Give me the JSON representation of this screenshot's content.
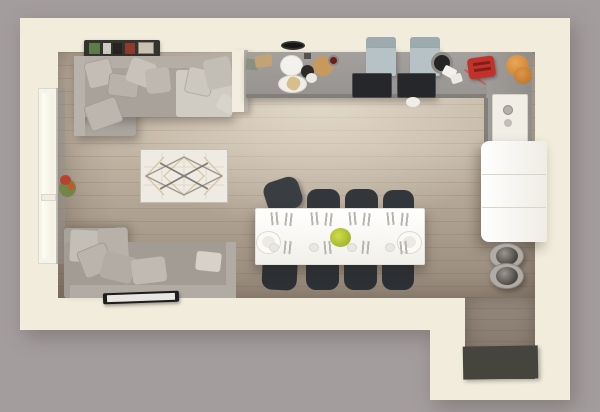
{
  "scene": {
    "label": "3D top-down floor plan render of an open-plan living room, dining area, kitchen and entryway with dark door mat"
  },
  "palette": {
    "background": "#a49d9d",
    "wall": "#f1ecdc",
    "floor_light": "#c4b7a6",
    "floor_dark": "#a2968a",
    "counter_gray": "#9d9996",
    "sofa_gray": "#a8a29b",
    "pillow_gray": "#c3bdb5",
    "chair_dark": "#33373c",
    "chair_blue": "#b6c2c5",
    "table_white": "#ffffff",
    "fridge_white": "#f9f7f2",
    "mat_dark": "#45453e",
    "accent_red": "#c2322a",
    "accent_orange": "#d78e3c",
    "accent_green_centerpiece": "#aabf2e",
    "plant_red": "#b8422c",
    "rug_cream": "#efebe3"
  },
  "furniture": [
    {
      "name": "window-left-frame",
      "x": 38,
      "y": 88,
      "w": 20,
      "h": 176,
      "bg": "#f6f3e9",
      "border": "1px solid #dedacb"
    },
    {
      "name": "window-left-pane",
      "x": 42,
      "y": 93,
      "w": 11,
      "h": 166,
      "bg": "linear-gradient(90deg,#fffef6,#f3f0e2)"
    },
    {
      "name": "window-left-sill",
      "x": 41,
      "y": 194,
      "w": 15,
      "h": 7,
      "bg": "#f0ede0",
      "border": "1px solid #dcd8c9"
    },
    {
      "name": "left-wall-inner-face",
      "x": 56,
      "y": 88,
      "w": 9,
      "h": 176,
      "bg": "#989390",
      "opacity": 0.55
    },
    {
      "name": "plant-leaves",
      "shape": "ellipse",
      "x": 59,
      "y": 179,
      "w": 17,
      "h": 18,
      "bg": "#72864a"
    },
    {
      "name": "plant-flowers",
      "shape": "ellipse",
      "x": 60,
      "y": 175,
      "w": 11,
      "h": 10,
      "bg": "#b8422c"
    },
    {
      "name": "plant-flower-2",
      "shape": "ellipse",
      "x": 68,
      "y": 183,
      "w": 7,
      "h": 7,
      "bg": "#c2582f"
    },
    {
      "name": "picture-shelf",
      "x": 84,
      "y": 40,
      "w": 76,
      "h": 17,
      "bg": "#35332f",
      "radius": "2px",
      "shadow": "0 2px 4px rgba(0,0,0,.3)"
    },
    {
      "name": "shelf-book-green",
      "x": 89,
      "y": 43,
      "w": 11,
      "h": 11,
      "bg": "#5c7c4a"
    },
    {
      "name": "shelf-book-white",
      "x": 103,
      "y": 43,
      "w": 8,
      "h": 11,
      "bg": "#cfcabf"
    },
    {
      "name": "shelf-book-dark",
      "x": 113,
      "y": 43,
      "w": 9,
      "h": 11,
      "bg": "#26241f"
    },
    {
      "name": "shelf-book-red",
      "x": 125,
      "y": 43,
      "w": 10,
      "h": 11,
      "bg": "#8e3a2e"
    },
    {
      "name": "shelf-art-print",
      "x": 138,
      "y": 42,
      "w": 16,
      "h": 12,
      "bg": "#c9c2b2",
      "border": "1px solid #8b857a"
    },
    {
      "name": "sofa-top-chaise",
      "x": 74,
      "y": 56,
      "w": 62,
      "h": 80,
      "bg": "#aba59e",
      "radius": "3px",
      "shadow": "3px 5px 9px rgba(40,35,30,.32)"
    },
    {
      "name": "sofa-top-base",
      "x": 74,
      "y": 56,
      "w": 158,
      "h": 61,
      "bg": "#a8a29b",
      "radius": "3px",
      "shadow": "3px 5px 9px rgba(40,35,30,.32)"
    },
    {
      "name": "sofa-top-armrest-left",
      "x": 74,
      "y": 56,
      "w": 11,
      "h": 80,
      "bg": "#b8b2ab"
    },
    {
      "name": "sofa-top-seat-right",
      "x": 176,
      "y": 70,
      "w": 56,
      "h": 47,
      "bg": "#d0cbc3",
      "radius": "3px"
    },
    {
      "name": "sofa-top-backrest",
      "x": 85,
      "y": 56,
      "w": 147,
      "h": 12,
      "bg": "#b4aea7"
    },
    {
      "name": "pillow-1",
      "x": 86,
      "y": 60,
      "w": 27,
      "h": 27,
      "bg": "#c3bdb5",
      "rot": -14,
      "radius": "4px",
      "border": "1px solid #a8a29a"
    },
    {
      "name": "pillow-2",
      "x": 108,
      "y": 74,
      "w": 31,
      "h": 23,
      "bg": "#b8b2aa",
      "rot": 7,
      "radius": "4px",
      "border": "1px solid #a29c94"
    },
    {
      "name": "pillow-3",
      "x": 128,
      "y": 60,
      "w": 26,
      "h": 25,
      "bg": "#c8c2ba",
      "rot": 20,
      "radius": "4px"
    },
    {
      "name": "pillow-4",
      "x": 146,
      "y": 68,
      "w": 24,
      "h": 25,
      "bg": "#beb8b0",
      "rot": -6,
      "radius": "4px"
    },
    {
      "name": "pillow-5",
      "x": 186,
      "y": 68,
      "w": 27,
      "h": 27,
      "bg": "#ccc7bf",
      "rot": 12,
      "radius": "4px",
      "border": "1px solid #b2ada5"
    },
    {
      "name": "pillow-6",
      "x": 205,
      "y": 58,
      "w": 27,
      "h": 30,
      "bg": "#c2bdb5",
      "rot": -12,
      "radius": "4px"
    },
    {
      "name": "pillow-7",
      "x": 90,
      "y": 97,
      "w": 27,
      "h": 34,
      "bg": "#bcb6ae",
      "rot": 70,
      "radius": "4px",
      "border": "1px solid #a39d95"
    },
    {
      "name": "pillow-8",
      "x": 218,
      "y": 96,
      "w": 18,
      "h": 16,
      "bg": "#d8d4cc",
      "rot": 30,
      "radius": "3px"
    },
    {
      "name": "sofa-bottom-chaise",
      "x": 64,
      "y": 228,
      "w": 64,
      "h": 70,
      "bg": "#a8a29b",
      "radius": "3px",
      "shadow": "3px -3px 8px rgba(40,35,30,.25)"
    },
    {
      "name": "sofa-bottom-base",
      "x": 64,
      "y": 242,
      "w": 172,
      "h": 56,
      "bg": "#a29c95",
      "radius": "3px"
    },
    {
      "name": "sofa-bottom-backrest",
      "x": 70,
      "y": 285,
      "w": 166,
      "h": 13,
      "bg": "#b1aba4"
    },
    {
      "name": "sofa-bottom-armrest-right",
      "x": 226,
      "y": 242,
      "w": 10,
      "h": 56,
      "bg": "#b1aba4"
    },
    {
      "name": "cushion-block-1",
      "x": 70,
      "y": 230,
      "w": 28,
      "h": 32,
      "bg": "#c3beb6",
      "rot": 3,
      "radius": "3px"
    },
    {
      "name": "cushion-block-2",
      "x": 98,
      "y": 228,
      "w": 30,
      "h": 34,
      "bg": "#b7b1a9",
      "rot": -4,
      "radius": "3px"
    },
    {
      "name": "pillow-9",
      "x": 80,
      "y": 246,
      "w": 31,
      "h": 29,
      "bg": "#bab4ac",
      "rot": -22,
      "radius": "4px",
      "border": "1px solid #a19b93"
    },
    {
      "name": "pillow-10",
      "x": 102,
      "y": 254,
      "w": 32,
      "h": 27,
      "bg": "#b2aca4",
      "rot": 14,
      "radius": "4px"
    },
    {
      "name": "pillow-11",
      "x": 132,
      "y": 258,
      "w": 34,
      "h": 25,
      "bg": "#c0bab2",
      "rot": -7,
      "radius": "4px"
    },
    {
      "name": "pillow-12",
      "x": 196,
      "y": 252,
      "w": 25,
      "h": 19,
      "bg": "#d6d2ca",
      "rot": 6,
      "radius": "3px"
    },
    {
      "name": "tv",
      "x": 103,
      "y": 292,
      "w": 76,
      "h": 11,
      "bg": "#1e1d1b",
      "radius": "2px",
      "rot": -2,
      "shadow": "1px 2px 3px rgba(0,0,0,.35)"
    },
    {
      "name": "tv-screen",
      "x": 107,
      "y": 294,
      "w": 68,
      "h": 7,
      "bg": "#e8e7e3",
      "rot": -2
    },
    {
      "name": "partition-wall",
      "x": 232,
      "y": 50,
      "w": 15,
      "h": 62,
      "bg": "#f2edde",
      "shadow": "4px 3px 6px rgba(0,0,0,.22)"
    },
    {
      "name": "partition-wall-face",
      "x": 244,
      "y": 50,
      "w": 4,
      "h": 62,
      "bg": "#b7b2a9"
    },
    {
      "name": "kitchen-counter",
      "x": 246,
      "y": 52,
      "w": 192,
      "h": 46,
      "bg": "linear-gradient(180deg,#a4a09d,#96928f)",
      "shadow": "0 4px 6px rgba(40,35,30,.3)"
    },
    {
      "name": "corner-counter-top",
      "x": 438,
      "y": 52,
      "w": 94,
      "h": 46,
      "bg": "linear-gradient(180deg,#a4a09d,#989491)"
    },
    {
      "name": "corner-counter-side",
      "x": 487,
      "y": 52,
      "w": 45,
      "h": 96,
      "bg": "linear-gradient(90deg,#a09c99,#918d8a)"
    },
    {
      "name": "counter-front-edge",
      "x": 246,
      "y": 94,
      "w": 240,
      "h": 4,
      "bg": "#827e7a"
    },
    {
      "name": "counter-side-edge",
      "x": 484,
      "y": 98,
      "w": 4,
      "h": 48,
      "bg": "#827e7a"
    },
    {
      "name": "dish-towel",
      "x": 246,
      "y": 59,
      "w": 12,
      "h": 11,
      "bg": "#87917f",
      "rot": 8
    },
    {
      "name": "cutting-board",
      "x": 255,
      "y": 55,
      "w": 17,
      "h": 12,
      "bg": "#c3a276",
      "rot": -8,
      "radius": "2px"
    },
    {
      "name": "pendant-lamp",
      "shape": "ellipse",
      "x": 281,
      "y": 41,
      "w": 24,
      "h": 9,
      "bg": "#161616",
      "border": "2px solid #323232"
    },
    {
      "name": "plate-large",
      "shape": "ellipse",
      "x": 280,
      "y": 55,
      "w": 23,
      "h": 21,
      "bg": "#f3f1ec",
      "border": "1px solid #dddbd4"
    },
    {
      "name": "bowl-dark",
      "shape": "ellipse",
      "x": 301,
      "y": 65,
      "w": 13,
      "h": 13,
      "bg": "#2c2a27"
    },
    {
      "name": "bowl-white",
      "shape": "ellipse",
      "x": 306,
      "y": 73,
      "w": 11,
      "h": 10,
      "bg": "#ebe9e4"
    },
    {
      "name": "serving-board-round",
      "shape": "ellipse",
      "x": 313,
      "y": 56,
      "w": 20,
      "h": 20,
      "bg": "#c8995c"
    },
    {
      "name": "mug-red",
      "shape": "ellipse",
      "x": 328,
      "y": 55,
      "w": 11,
      "h": 11,
      "bg": "#6b1d18",
      "border": "2px solid #8c8884"
    },
    {
      "name": "bread-plate",
      "shape": "ellipse",
      "x": 278,
      "y": 75,
      "w": 29,
      "h": 18,
      "bg": "#f0eee8",
      "border": "1px solid #dcdad3"
    },
    {
      "name": "bread",
      "x": 287,
      "y": 77,
      "w": 13,
      "h": 13,
      "bg": "#d7bf8c",
      "rot": 25,
      "radius": "40%"
    },
    {
      "name": "spice-jar",
      "x": 304,
      "y": 53,
      "w": 7,
      "h": 6,
      "bg": "#55514c"
    },
    {
      "name": "desk-chair-left-back",
      "x": 366,
      "y": 37,
      "w": 30,
      "h": 13,
      "bg": "#9dabaf",
      "radius": "3px 3px 0 0"
    },
    {
      "name": "desk-chair-left-seat",
      "x": 366,
      "y": 48,
      "w": 30,
      "h": 28,
      "bg": "#b6c2c5",
      "radius": "2px",
      "shadow": "2px 2px 4px rgba(0,0,0,.2)"
    },
    {
      "name": "desk-chair-right-back",
      "x": 410,
      "y": 37,
      "w": 30,
      "h": 13,
      "bg": "#9dabaf",
      "radius": "3px 3px 0 0"
    },
    {
      "name": "desk-chair-right-seat",
      "x": 410,
      "y": 48,
      "w": 30,
      "h": 28,
      "bg": "#b6c2c5",
      "radius": "2px",
      "shadow": "2px 2px 4px rgba(0,0,0,.2)"
    },
    {
      "name": "desk-left",
      "x": 352,
      "y": 73,
      "w": 40,
      "h": 25,
      "bg": "#25272a",
      "radius": "2px",
      "border": "1px solid #4a4c4e"
    },
    {
      "name": "desk-right",
      "x": 397,
      "y": 73,
      "w": 39,
      "h": 25,
      "bg": "#25272a",
      "radius": "2px",
      "border": "1px solid #4a4c4e"
    },
    {
      "name": "paper-crumb-floor",
      "shape": "ellipse",
      "x": 406,
      "y": 97,
      "w": 14,
      "h": 10,
      "bg": "#efede6"
    },
    {
      "name": "pot",
      "shape": "ellipse",
      "x": 431,
      "y": 52,
      "w": 22,
      "h": 22,
      "bg": "#252525",
      "border": "3px solid #8e8b87"
    },
    {
      "name": "paper-crumb-1",
      "x": 443,
      "y": 67,
      "w": 13,
      "h": 10,
      "bg": "#f2f0eb",
      "rot": 28,
      "radius": "2px"
    },
    {
      "name": "paper-crumb-2",
      "x": 451,
      "y": 74,
      "w": 11,
      "h": 9,
      "bg": "#ece9e3",
      "rot": -18,
      "radius": "2px"
    },
    {
      "name": "toaster-cord",
      "x": 462,
      "y": 76,
      "w": 26,
      "h": 2,
      "bg": "#b8685e",
      "rot": 35
    },
    {
      "name": "toaster",
      "x": 468,
      "y": 57,
      "w": 27,
      "h": 21,
      "bg": "#c2322a",
      "rot": -8,
      "radius": "4px",
      "shadow": "1px 2px 3px rgba(0,0,0,.3)"
    },
    {
      "name": "toaster-slot-1",
      "x": 473,
      "y": 62,
      "w": 17,
      "h": 3,
      "bg": "#7e1f1a",
      "rot": -8
    },
    {
      "name": "toaster-slot-2",
      "x": 474,
      "y": 68,
      "w": 17,
      "h": 3,
      "bg": "#7e1f1a",
      "rot": -8
    },
    {
      "name": "jar-orange-large",
      "shape": "ellipse",
      "x": 506,
      "y": 55,
      "w": 23,
      "h": 21,
      "bg": "radial-gradient(circle at 40% 35%, #e9a755, #c57a2e)"
    },
    {
      "name": "jar-orange-small",
      "shape": "ellipse",
      "x": 514,
      "y": 67,
      "w": 18,
      "h": 17,
      "bg": "radial-gradient(circle at 40% 35%, #dd9544, #b96f28)"
    },
    {
      "name": "built-in-appliance",
      "x": 492,
      "y": 94,
      "w": 36,
      "h": 52,
      "bg": "#f1eee6",
      "radius": "2px",
      "border": "1px solid #d6d2c6"
    },
    {
      "name": "appliance-dial",
      "shape": "ellipse",
      "x": 503,
      "y": 105,
      "w": 10,
      "h": 10,
      "bg": "#b5b1aa",
      "border": "1px solid #918d86"
    },
    {
      "name": "appliance-dial-2",
      "shape": "ellipse",
      "x": 504,
      "y": 119,
      "w": 8,
      "h": 8,
      "bg": "#c2beb7"
    },
    {
      "name": "fridge",
      "x": 481,
      "y": 141,
      "w": 66,
      "h": 101,
      "bg": "linear-gradient(90deg,#ffffff,#efece4)",
      "radius": "8px 2px 2px 8px",
      "shadow": "-4px 6px 12px rgba(40,35,30,.35)"
    },
    {
      "name": "fridge-seam-1",
      "x": 482,
      "y": 174,
      "w": 64,
      "h": 1,
      "bg": "#d9d5c9"
    },
    {
      "name": "fridge-seam-2",
      "x": 482,
      "y": 207,
      "w": 64,
      "h": 1,
      "bg": "#d9d5c9"
    },
    {
      "name": "stool-1",
      "shape": "ellipse",
      "x": 489,
      "y": 243,
      "w": 35,
      "h": 26,
      "bg": "#b0aca5",
      "border": "1px solid #8b8781",
      "shadow": "2px 3px 5px rgba(0,0,0,.3)"
    },
    {
      "name": "stool-1-seat",
      "shape": "ellipse",
      "x": 496,
      "y": 247,
      "w": 22,
      "h": 18,
      "bg": "radial-gradient(circle at 38% 35%, #9a968f, #4a4641 70%)"
    },
    {
      "name": "stool-2",
      "shape": "ellipse",
      "x": 489,
      "y": 263,
      "w": 35,
      "h": 26,
      "bg": "#b0aca5",
      "border": "1px solid #8b8781",
      "shadow": "2px 3px 5px rgba(0,0,0,.3)"
    },
    {
      "name": "stool-2-seat",
      "shape": "ellipse",
      "x": 496,
      "y": 267,
      "w": 22,
      "h": 18,
      "bg": "radial-gradient(circle at 38% 35%, #9a968f, #4a4641 70%)"
    },
    {
      "name": "dining-chair-1",
      "x": 265,
      "y": 179,
      "w": 36,
      "h": 32,
      "bg": "#3a3e43",
      "radius": "10px",
      "rot": -18,
      "shadow": "2px 3px 5px rgba(0,0,0,.3)"
    },
    {
      "name": "dining-chair-2",
      "x": 307,
      "y": 189,
      "w": 33,
      "h": 25,
      "bg": "#33373c",
      "radius": "10px 10px 4px 4px"
    },
    {
      "name": "dining-chair-3",
      "x": 345,
      "y": 189,
      "w": 33,
      "h": 25,
      "bg": "#33373c",
      "radius": "10px 10px 4px 4px"
    },
    {
      "name": "dining-chair-4",
      "x": 383,
      "y": 190,
      "w": 31,
      "h": 24,
      "bg": "#33373c",
      "radius": "10px 10px 4px 4px"
    },
    {
      "name": "dining-chair-5",
      "x": 262,
      "y": 262,
      "w": 35,
      "h": 28,
      "bg": "#2d3136",
      "radius": "4px 4px 10px 10px",
      "rot": 3
    },
    {
      "name": "dining-chair-6",
      "x": 306,
      "y": 262,
      "w": 33,
      "h": 28,
      "bg": "#2d3136",
      "radius": "4px 4px 10px 10px"
    },
    {
      "name": "dining-chair-7",
      "x": 344,
      "y": 262,
      "w": 33,
      "h": 28,
      "bg": "#2d3136",
      "radius": "4px 4px 10px 10px"
    },
    {
      "name": "dining-chair-8",
      "x": 382,
      "y": 262,
      "w": 32,
      "h": 28,
      "bg": "#2d3136",
      "radius": "4px 4px 10px 10px"
    },
    {
      "name": "dining-table",
      "x": 255,
      "y": 208,
      "w": 170,
      "h": 57,
      "bg": "linear-gradient(180deg,#ffffff,#f2f0ea)",
      "radius": "2px",
      "border": "1px solid #e4e2da",
      "shadow": "0 6px 12px rgba(45,38,32,.4)"
    },
    {
      "name": "platter-left",
      "shape": "ellipse",
      "x": 256,
      "y": 231,
      "w": 25,
      "h": 23,
      "bg": "#fbfaf7",
      "border": "1px solid #dcdad2"
    },
    {
      "name": "platter-left-inner",
      "shape": "ellipse",
      "x": 262,
      "y": 236,
      "w": 13,
      "h": 12,
      "bg": "#eceae2"
    },
    {
      "name": "platter-right",
      "shape": "ellipse",
      "x": 397,
      "y": 231,
      "w": 25,
      "h": 23,
      "bg": "#fbfaf7",
      "border": "1px solid #dcdad2"
    },
    {
      "name": "platter-right-inner",
      "shape": "ellipse",
      "x": 403,
      "y": 236,
      "w": 13,
      "h": 12,
      "bg": "#eceae2"
    },
    {
      "name": "centerpiece",
      "shape": "ellipse",
      "x": 330,
      "y": 228,
      "w": 21,
      "h": 19,
      "bg": "radial-gradient(circle at 40% 40%, #cedd4a, #94a61f)"
    },
    {
      "name": "cutlery",
      "x": 271,
      "y": 212,
      "w": 9,
      "h": 13,
      "cutlery": true,
      "rot": -5
    },
    {
      "name": "cutlery",
      "x": 285,
      "y": 213,
      "w": 9,
      "h": 13,
      "cutlery": true,
      "rot": 6
    },
    {
      "name": "cutlery",
      "x": 311,
      "y": 212,
      "w": 9,
      "h": 13,
      "cutlery": true,
      "rot": -5
    },
    {
      "name": "cutlery",
      "x": 325,
      "y": 213,
      "w": 9,
      "h": 13,
      "cutlery": true,
      "rot": 6
    },
    {
      "name": "cutlery",
      "x": 349,
      "y": 212,
      "w": 9,
      "h": 13,
      "cutlery": true,
      "rot": -5
    },
    {
      "name": "cutlery",
      "x": 363,
      "y": 213,
      "w": 9,
      "h": 13,
      "cutlery": true,
      "rot": 6
    },
    {
      "name": "cutlery",
      "x": 387,
      "y": 212,
      "w": 9,
      "h": 13,
      "cutlery": true,
      "rot": -5
    },
    {
      "name": "cutlery",
      "x": 401,
      "y": 213,
      "w": 9,
      "h": 13,
      "cutlery": true,
      "rot": 6
    },
    {
      "name": "side-plate",
      "shape": "ellipse",
      "x": 269,
      "y": 243,
      "w": 10,
      "h": 9,
      "bg": "#e9e7e0",
      "border": "1px solid #d8d6ce"
    },
    {
      "name": "side-plate",
      "shape": "ellipse",
      "x": 309,
      "y": 243,
      "w": 10,
      "h": 9,
      "bg": "#e9e7e0",
      "border": "1px solid #d8d6ce"
    },
    {
      "name": "side-plate",
      "shape": "ellipse",
      "x": 347,
      "y": 243,
      "w": 10,
      "h": 9,
      "bg": "#e9e7e0",
      "border": "1px solid #d8d6ce"
    },
    {
      "name": "side-plate",
      "shape": "ellipse",
      "x": 385,
      "y": 243,
      "w": 10,
      "h": 9,
      "bg": "#e9e7e0",
      "border": "1px solid #d8d6ce"
    },
    {
      "name": "cutlery",
      "x": 284,
      "y": 241,
      "w": 9,
      "h": 13,
      "cutlery": true,
      "rot": 5
    },
    {
      "name": "cutlery",
      "x": 324,
      "y": 241,
      "w": 9,
      "h": 13,
      "cutlery": true,
      "rot": -5
    },
    {
      "name": "cutlery",
      "x": 362,
      "y": 241,
      "w": 9,
      "h": 13,
      "cutlery": true,
      "rot": 5
    },
    {
      "name": "cutlery",
      "x": 400,
      "y": 241,
      "w": 9,
      "h": 13,
      "cutlery": true,
      "rot": -5
    },
    {
      "name": "door-mat",
      "x": 463,
      "y": 346,
      "w": 75,
      "h": 33,
      "bg": "#45453e",
      "rot": -1,
      "shadow": "2px 2px 4px rgba(0,0,0,.3)"
    }
  ]
}
